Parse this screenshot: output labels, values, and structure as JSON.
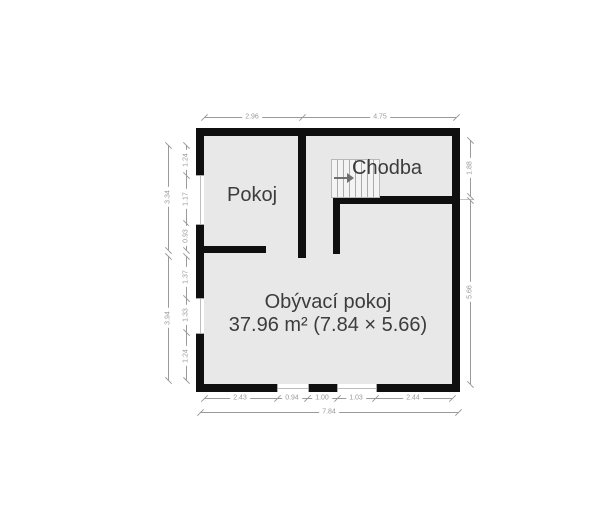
{
  "rooms": {
    "pokoj": {
      "label": "Pokoj"
    },
    "chodba": {
      "label": "Chodba"
    },
    "living": {
      "label": "Obývací pokoj",
      "area": "37.96 m² (7.84 × 5.66)"
    }
  },
  "dims": {
    "top": [
      "2.96",
      "4.75"
    ],
    "bottom": [
      "2.43",
      "0.94",
      "1.00",
      "1.03",
      "2.44"
    ],
    "bottom_total": "7.84",
    "left_top": [
      "1.24",
      "1.17",
      "0.93"
    ],
    "left_top_total": "3.34",
    "left_bottom": [
      "1.37",
      "1.33",
      "1.24"
    ],
    "left_bottom_total": "3.94",
    "right_top": "1.88",
    "right_bottom": "5.66"
  },
  "icons": {
    "stairs_arrow": "right-arrow"
  },
  "colors": {
    "wall": "#0f0f0f",
    "floor": "#e8e8e8",
    "dim": "#9a9a9a",
    "label": "#3c3c3c",
    "stair-line": "#ababab"
  }
}
